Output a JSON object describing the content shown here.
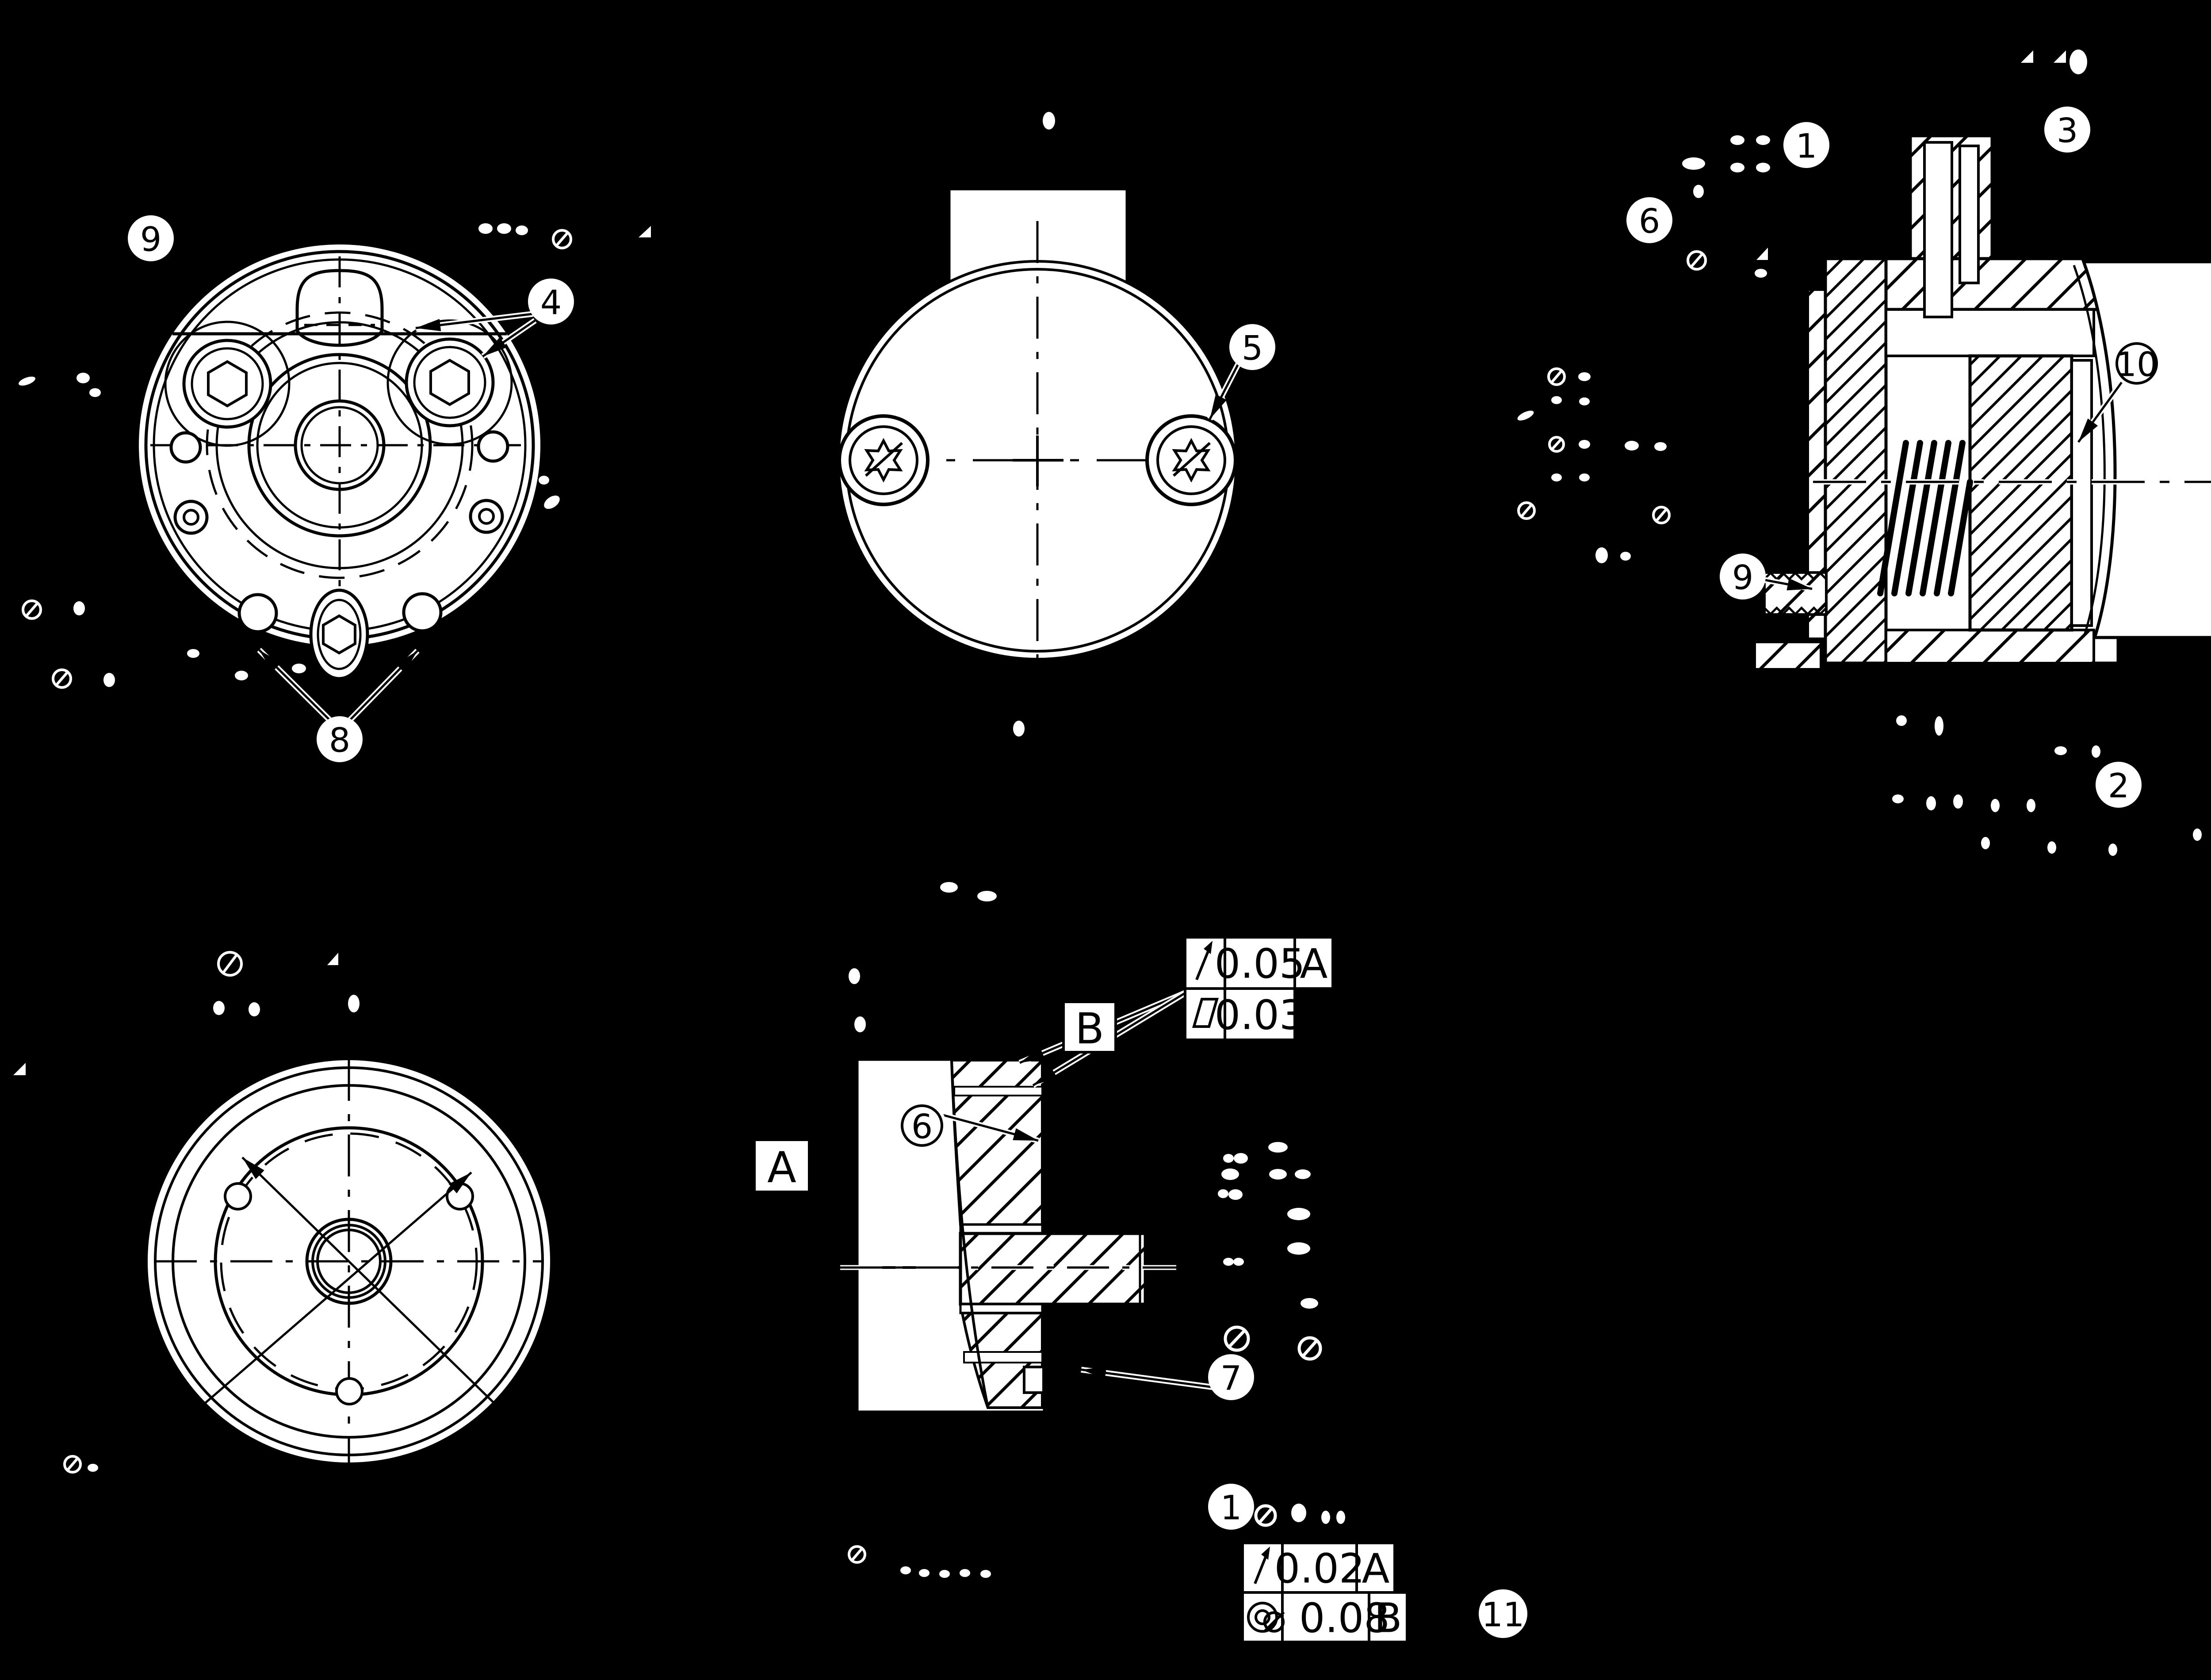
{
  "drawing": {
    "background_color": "#000000",
    "face_color": "#ffffff",
    "line_color": "#000000",
    "type": "mechanical engineering drawing, multi-view with section views and GD&T"
  },
  "balloons": [
    {
      "label": "9"
    },
    {
      "label": "4"
    },
    {
      "label": "8"
    },
    {
      "label": "5"
    },
    {
      "label": "1"
    },
    {
      "label": "3"
    },
    {
      "label": "6"
    },
    {
      "label": "10"
    },
    {
      "label": "9"
    },
    {
      "label": "2"
    },
    {
      "label": "6"
    },
    {
      "label": "7"
    },
    {
      "label": "1"
    },
    {
      "label": "11"
    }
  ],
  "datums": {
    "a": "A",
    "b": "B"
  },
  "gdt": {
    "upper_frame": {
      "rows": [
        {
          "symbol_name": "circular-runout",
          "value": "0.05",
          "datum": "A"
        },
        {
          "symbol_name": "flatness",
          "value": "0.03",
          "datum": ""
        }
      ]
    },
    "lower_frame": {
      "rows": [
        {
          "symbol_name": "circular-runout",
          "value": "0.02",
          "datum": "A"
        },
        {
          "symbol_name": "concentricity",
          "value": "⌀ 0.08",
          "datum": "B"
        }
      ]
    }
  }
}
